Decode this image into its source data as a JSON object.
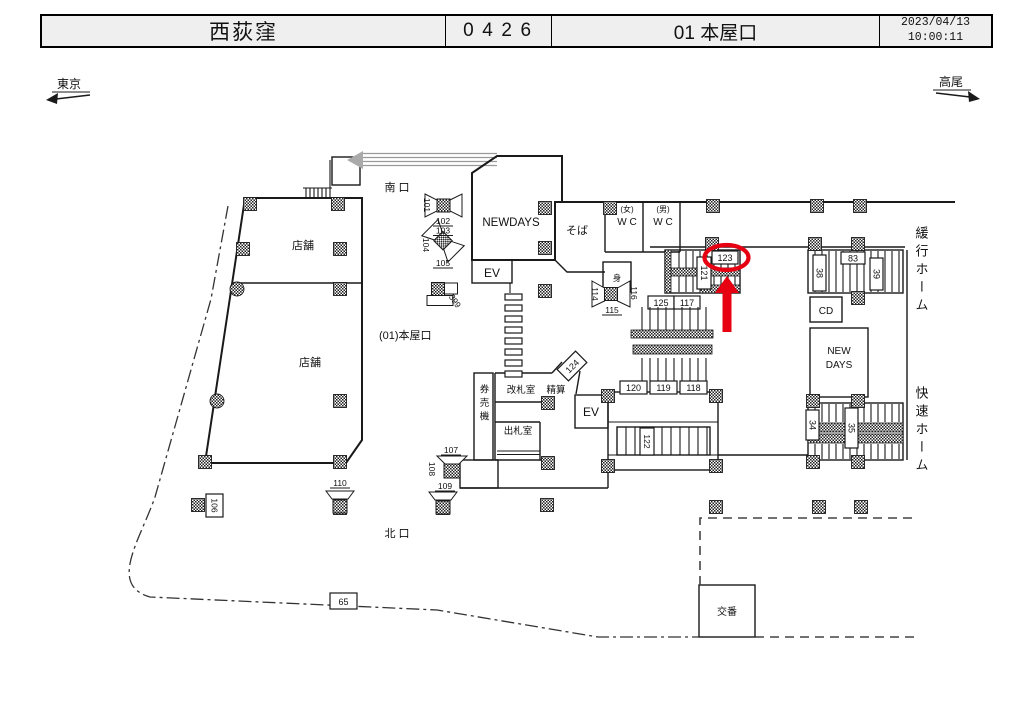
{
  "header": {
    "station_name": "西荻窪",
    "station_code": "0426",
    "location": "01 本屋口",
    "date": "2023/04/13",
    "time": "10:00:11"
  },
  "directions": {
    "left": "東京",
    "right": "高尾"
  },
  "map": {
    "exits": {
      "south": "南 口",
      "north": "北 口",
      "main": "(01)本屋口"
    },
    "rooms": {
      "store_upper": "店舗",
      "store_lower": "店舗",
      "newdays": "NEWDAYS",
      "soba": "そば",
      "wc_women_tag": "(女)",
      "wc_women": "W C",
      "wc_men_tag": "(男)",
      "wc_men": "W C",
      "accessible": "身",
      "ev_north": "EV",
      "ev_center": "EV",
      "gate_office": "改札室",
      "fare_adjustment": "精算",
      "ticket_machines": "券売機",
      "ticket_office": "出札室",
      "cd": "CD",
      "newdays_line1": "NEW",
      "newdays_line2": "DAYS",
      "police_box": "交番"
    },
    "platforms": {
      "local": "緩行ホーム",
      "rapid": "快速ホーム"
    },
    "numbers": {
      "n34": "34",
      "n35": "35",
      "n38": "38",
      "n39": "39",
      "n65": "65",
      "n83": "83",
      "n101": "101",
      "n102": "102",
      "n103": "103",
      "n104": "104",
      "n105": "105",
      "n106": "106",
      "n107": "107",
      "n108": "108",
      "n109": "109",
      "n110": "110",
      "n114": "114",
      "n115": "115",
      "n116": "116",
      "n117": "117",
      "n118": "118",
      "n119": "119",
      "n120": "120",
      "n121": "121",
      "n122": "122",
      "n123": "123",
      "n124": "124",
      "n125": "125",
      "n399": "399"
    },
    "highlight": {
      "target_number": "123",
      "color": "#e60012"
    }
  }
}
